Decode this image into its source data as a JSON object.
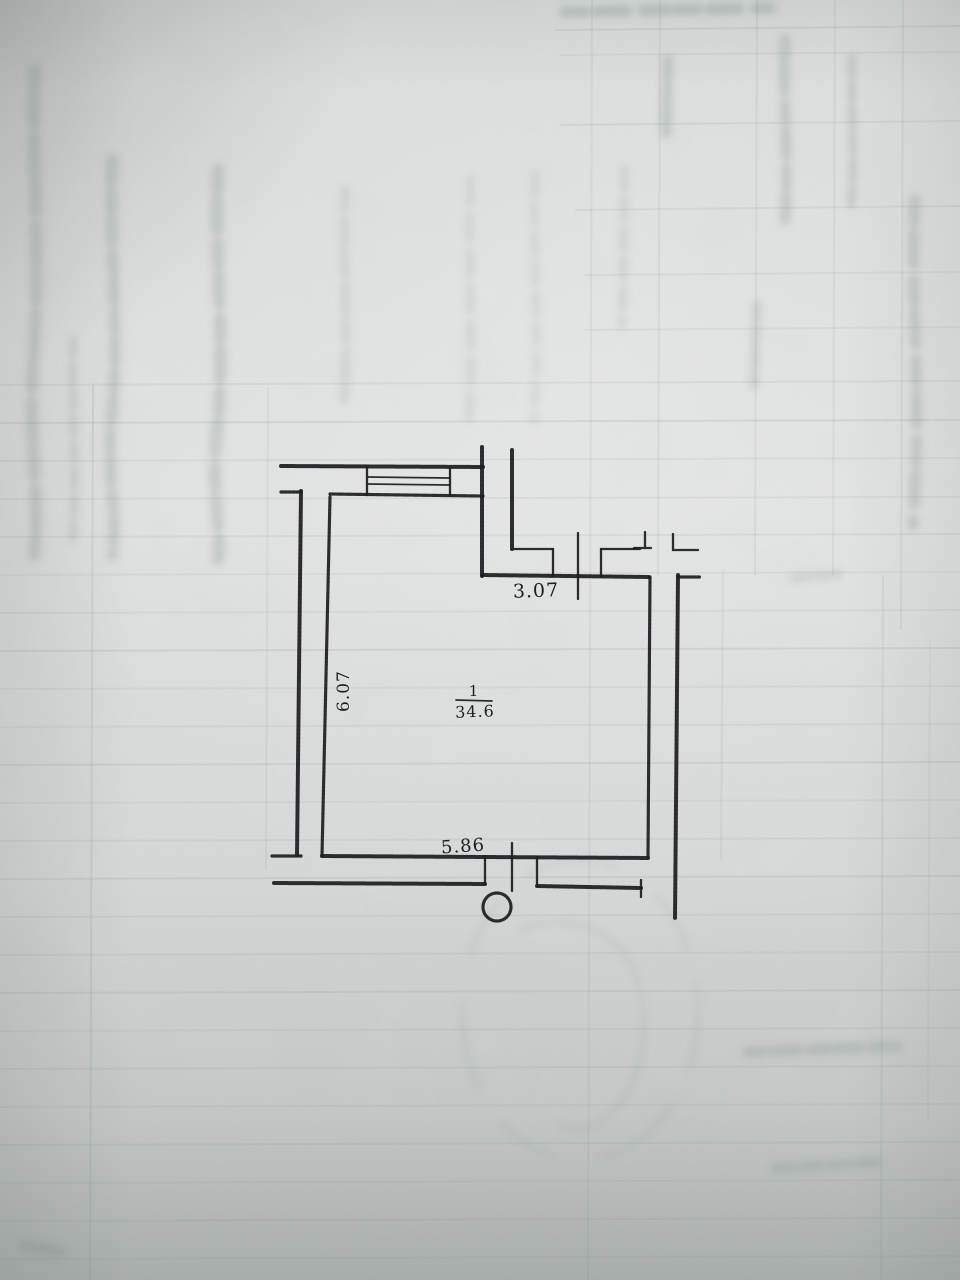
{
  "plan": {
    "room": {
      "number": "1",
      "area": "34.6"
    },
    "dimensions": {
      "top_width": "3.07",
      "left_height": "6.07",
      "bottom_width": "5.86"
    }
  },
  "colors": {
    "ink": "#1b1b1f",
    "paper": "#d9dcdb",
    "paper_light": "#e6e8e7",
    "paper_shadow": "#a9aead",
    "bleed_mark": "#74807a"
  }
}
